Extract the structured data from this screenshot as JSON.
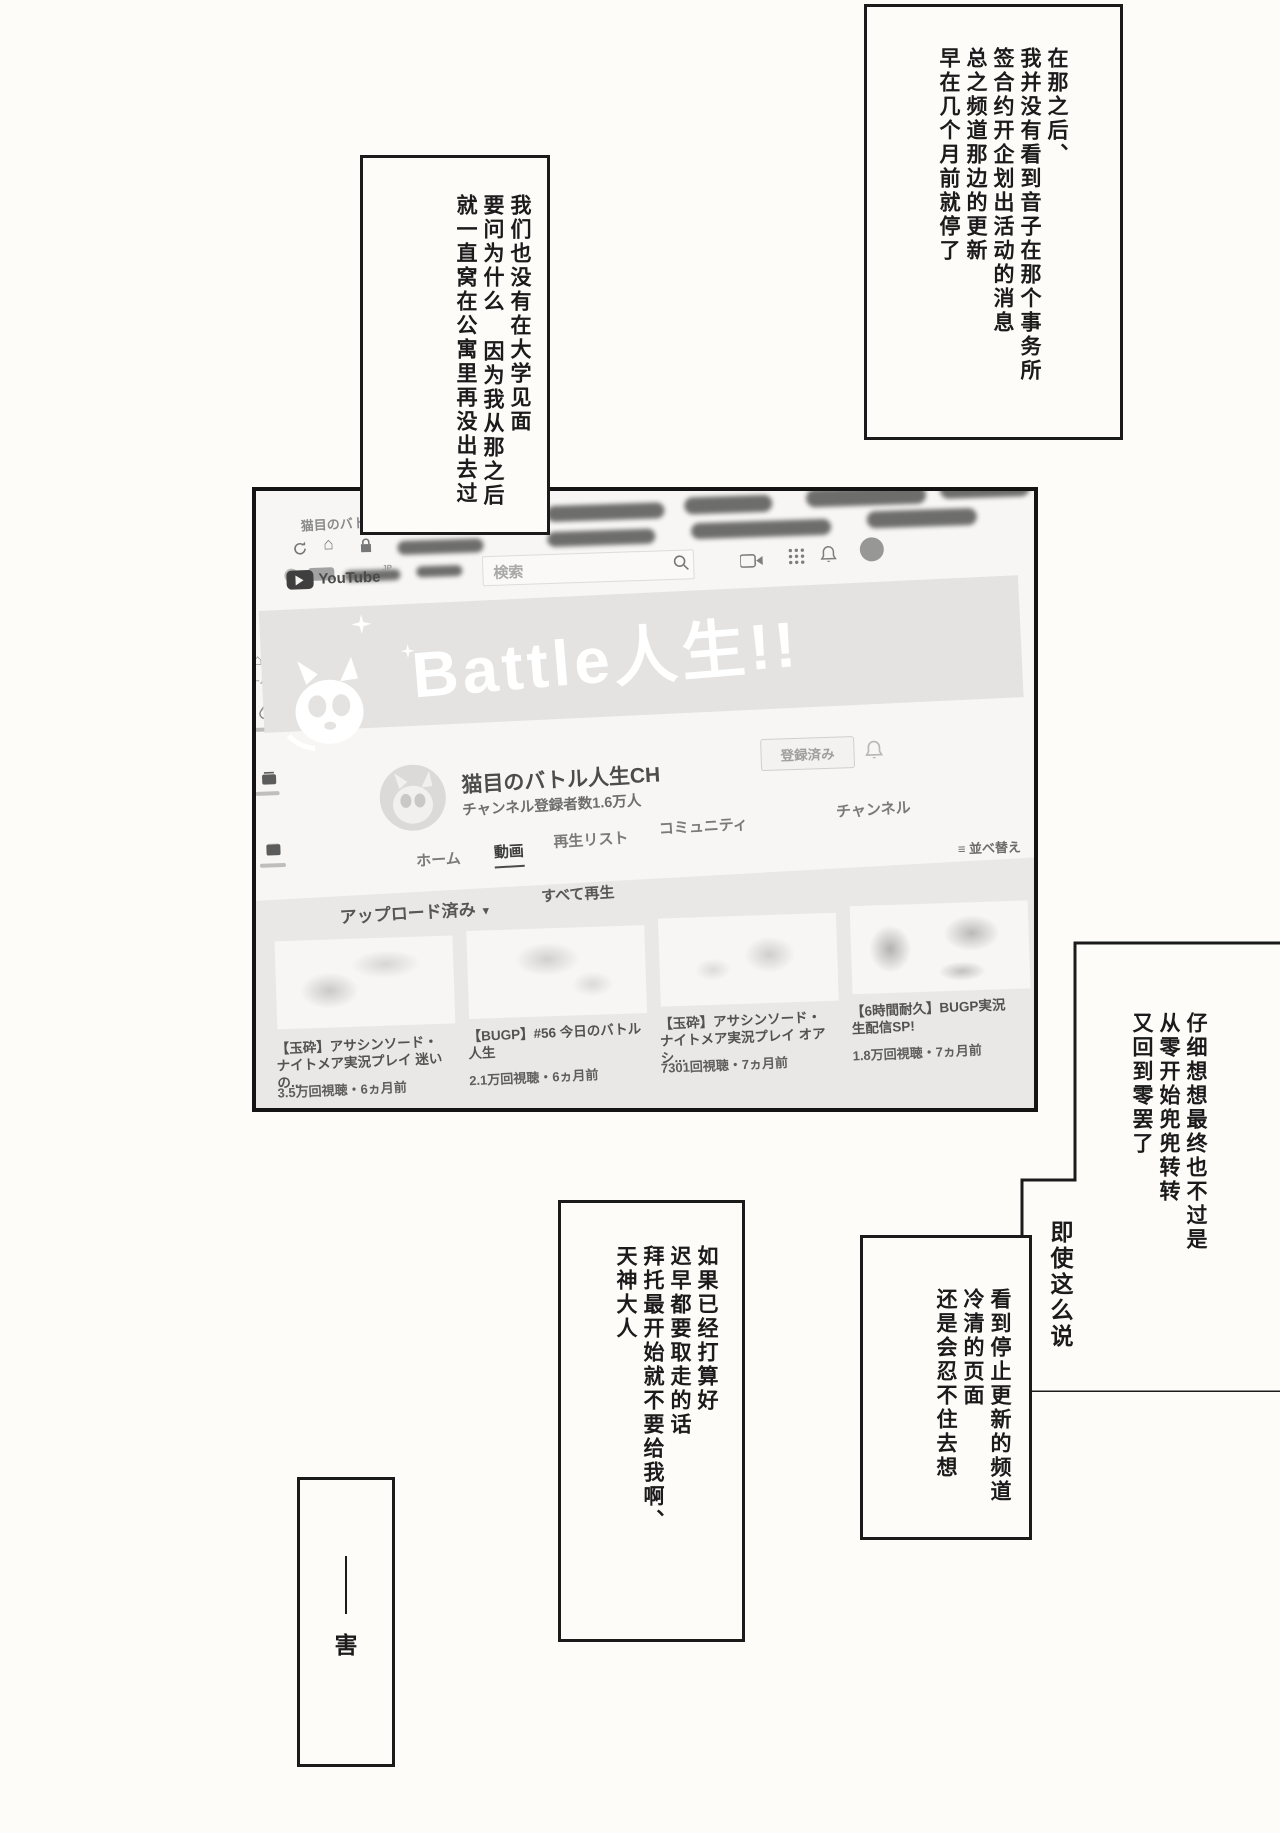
{
  "bubbles": {
    "top_right": {
      "lines": [
        "在那之后、",
        "我并没有看到音子在那个事务所",
        "签合约开企划出活动的消息",
        "总之频道那边的更新",
        "早在几个月前就停了"
      ]
    },
    "upper_left": {
      "lines": [
        "我们也没有在大学见面",
        "要问为什么 因为我从那之后",
        "就一直窝在公寓里再没出去过"
      ]
    },
    "right_mid": {
      "lines": [
        "仔细想想最终也不过是",
        "从零开始兜兜转转",
        "又回到零罢了"
      ]
    },
    "aside": {
      "text": "即使这么说"
    },
    "bottom_mid": {
      "lines": [
        "看到停止更新的频道",
        "冷清的页面",
        "还是会忍不住去想"
      ]
    },
    "bottom_center": {
      "lines": [
        "如果已经打算好",
        "迟早都要取走的话",
        "拜托最开始就不要给我啊、",
        "天神大人"
      ]
    },
    "bottom_left": {
      "text": "害"
    }
  },
  "browser": {
    "tab_title": "猫目のバトル人生CH - Yo",
    "search_placeholder": "検索"
  },
  "youtube": {
    "logo_text": "YouTube",
    "logo_region": "JP",
    "banner_text": "Battle人生!!",
    "channel_name": "猫目のバトル人生CH",
    "subscriber_count": "チャンネル登録者数1.6万人",
    "subscribe_button": "登録済み",
    "sidebar_home_label": "ーム",
    "tabs": [
      {
        "label": "ホーム"
      },
      {
        "label": "動画"
      },
      {
        "label": "再生リスト"
      },
      {
        "label": "コミュニティ"
      },
      {
        "label": "チャンネル"
      }
    ],
    "uploads_label": "アップロード済み",
    "play_all_label": "すべて再生",
    "sort_label": "並べ替え",
    "videos": [
      {
        "title_line1": "【玉砕】アサシンソード・",
        "title_line2": "ナイトメア実況プレイ 迷いの...",
        "meta": "3.5万回視聴・6ヵ月前"
      },
      {
        "title_line1": "【BUGP】#56 今日のバトル",
        "title_line2": "人生",
        "meta": "2.1万回視聴・6ヵ月前"
      },
      {
        "title_line1": "【玉砕】アサシンソード・",
        "title_line2": "ナイトメア実況プレイ オアシ...",
        "meta": "7301回視聴・7ヵ月前"
      },
      {
        "title_line1": "【6時間耐久】BUGP実況",
        "title_line2": "生配信SP!",
        "meta": "1.8万回視聴・7ヵ月前"
      }
    ]
  },
  "colors": {
    "ink": "#1b1b1b",
    "paper": "#fdfcf9",
    "photo_wash": "#f7f6f4",
    "banner_gray": "#e4e3e1",
    "section_gray": "#e9e8e6",
    "handwriting": "#565656"
  }
}
